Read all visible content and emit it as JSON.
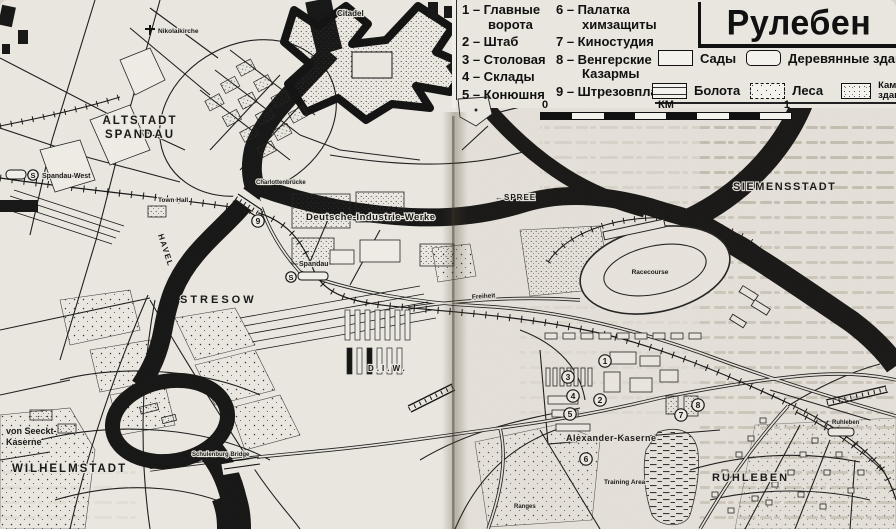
{
  "page": {
    "title": "Рулебен"
  },
  "legend": {
    "items": [
      "1 – Главные ворота",
      "2 – Штаб",
      "3 – Столовая",
      "4 – Склады",
      "5 – Конюшня",
      "6 – Палатка химзащиты",
      "7 – Киностудия",
      "8 – Венгерские Казармы",
      "9 – Штрезовплац"
    ],
    "symbols": [
      {
        "label": "Сады"
      },
      {
        "label": "Деревянные здания"
      },
      {
        "label": "Болота"
      },
      {
        "label": "Леса"
      },
      {
        "label": "Каменные здания"
      }
    ],
    "scale": {
      "left": "0",
      "unit": "КМ",
      "right": "1"
    }
  },
  "labels": {
    "church": "Nikolaikirche",
    "citadel": "Citadel",
    "altstadt1": "ALTSTADT",
    "altstadt2": "SPANDAU",
    "spandau_west": "Spandau-West",
    "town_hall": "Town Hall",
    "charlotten_bridge": "Charlottenbrücke",
    "havel": "HAVEL",
    "diw": "Deutsche-Industrie-Werke",
    "diw_abbr": "D.I.W.",
    "spree": "←SPREE",
    "siemensstadt": "SIEMENSSTADT",
    "spandau_station": "Spandau",
    "stresow": "STRESOW",
    "racecourse": "Racecourse",
    "freiheit": "Freiheit",
    "alexander": "Alexander-Kaserne",
    "training": "Training Area",
    "ranges": "Ranges",
    "ruhleben_big": "RUHLEBEN",
    "ruhleben_stn": "Ruhleben",
    "seeckt1": "von Seeckt-",
    "seeckt2": "Kaserne",
    "wilhelmstadt": "WILHELMSTADT",
    "schulenburg": "Schulenburg Bridge",
    "s_badge": "S"
  },
  "markers": [
    "1",
    "2",
    "3",
    "4",
    "5",
    "6",
    "7",
    "8",
    "9"
  ]
}
